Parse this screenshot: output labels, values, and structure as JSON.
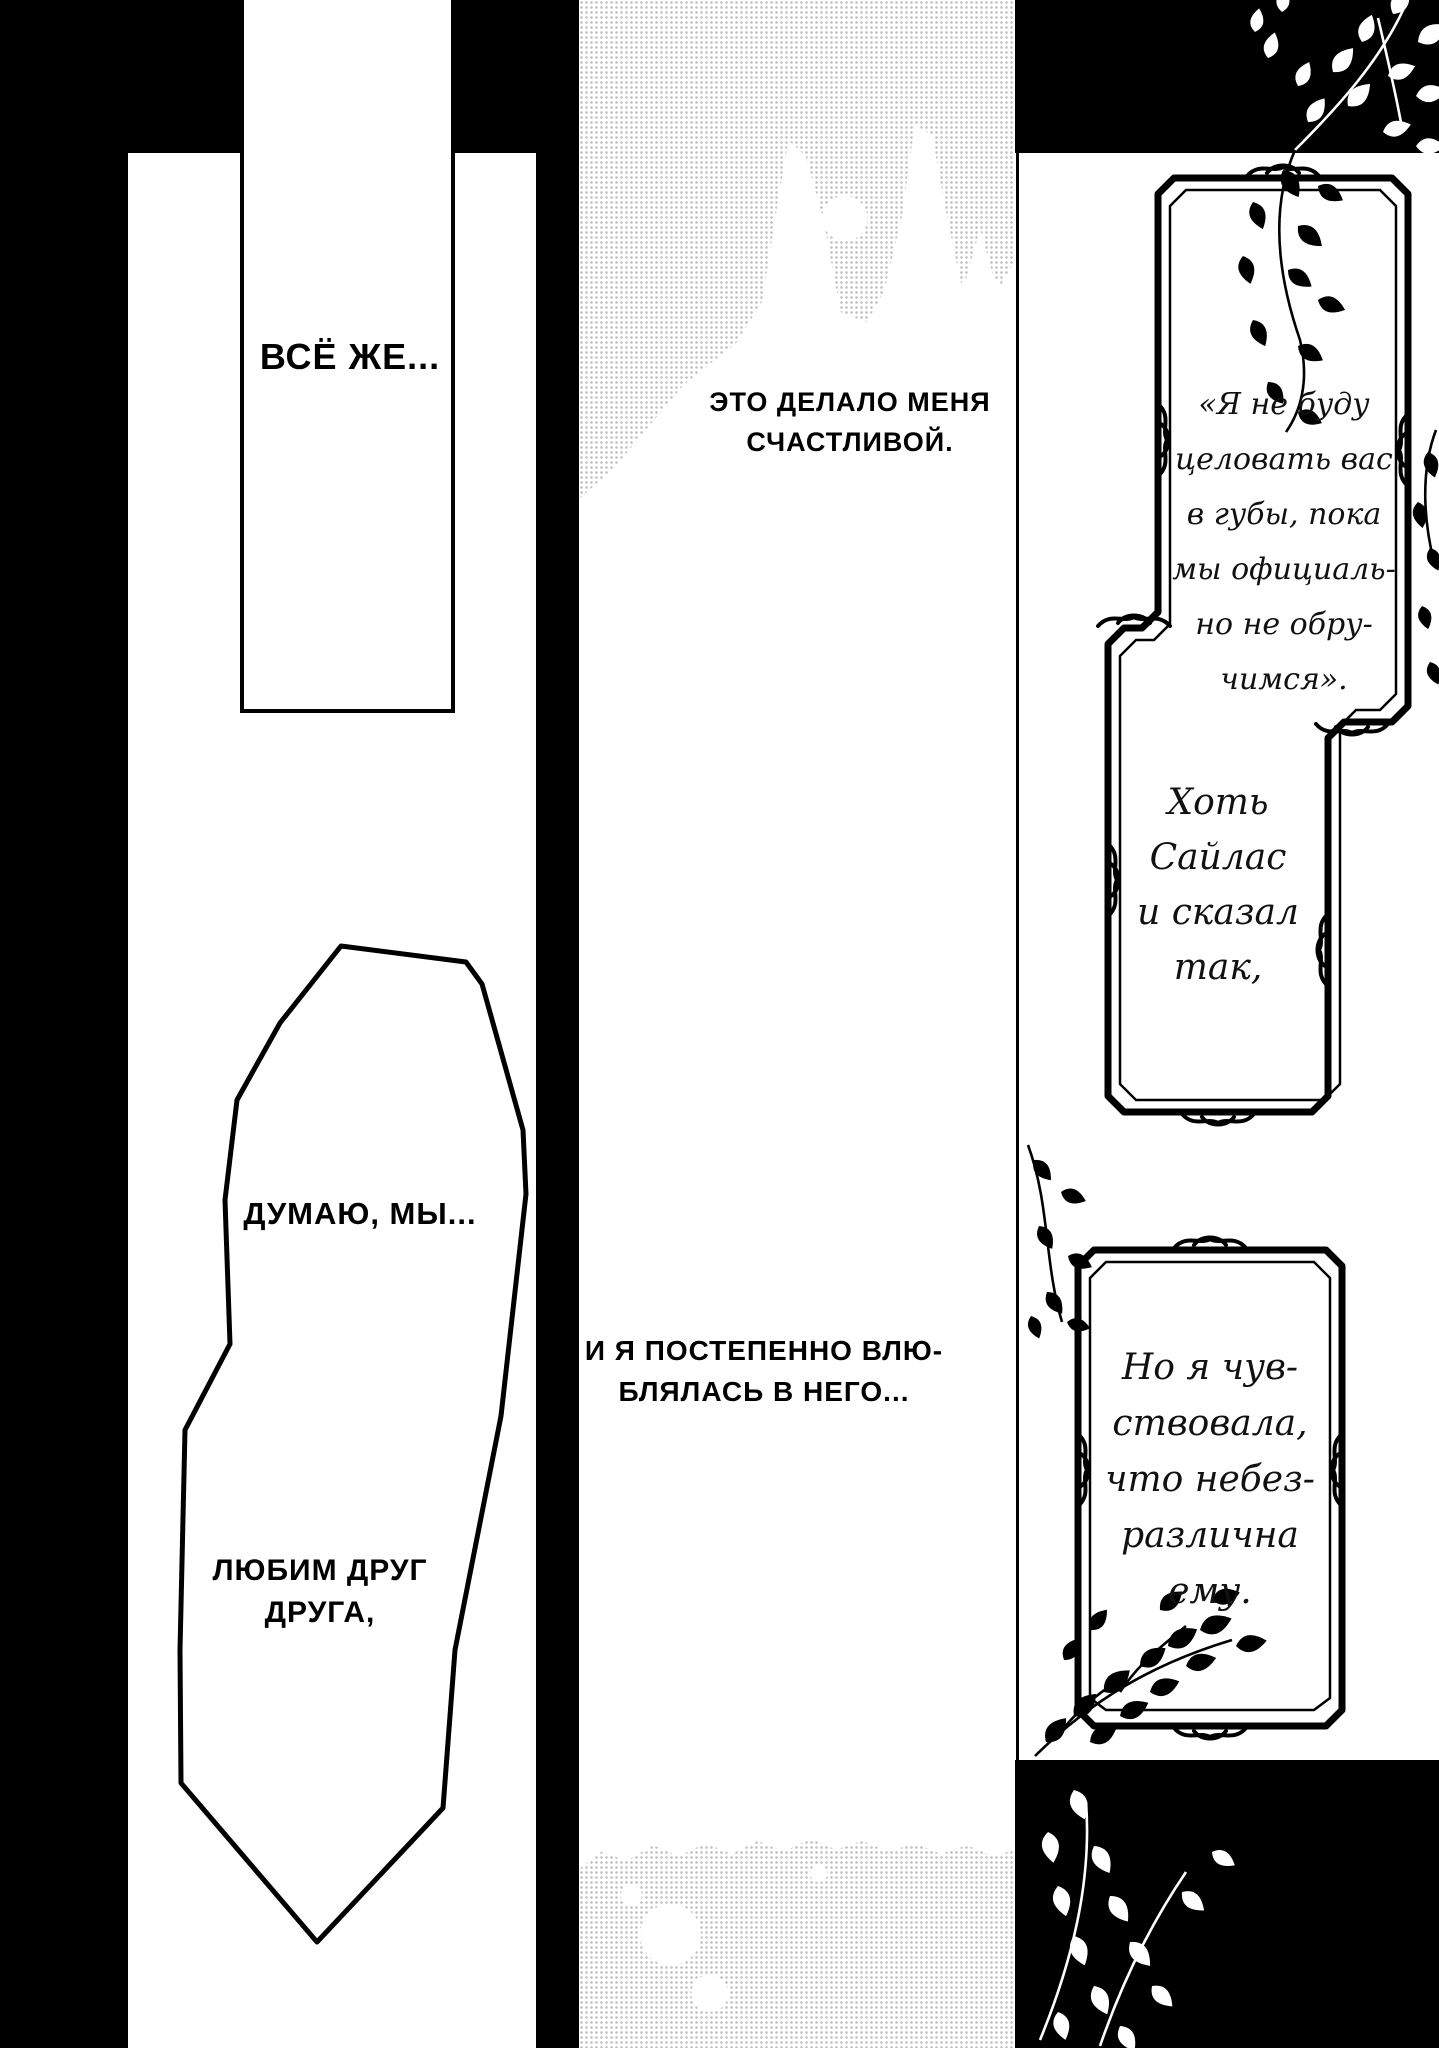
{
  "page_type": "manga-page",
  "colors": {
    "ink": "#000000",
    "paper": "#ffffff",
    "halftone_dot": "#bfbfbf"
  },
  "left_panel": {
    "top_caption": "ВСЁ ЖЕ...",
    "bubble": {
      "caption1": "ДУМАЮ, МЫ...",
      "caption2_line1": "ЛЮБИМ ДРУГ",
      "caption2_line2": "ДРУГА,"
    }
  },
  "middle_panel": {
    "top_caption": {
      "line1": "ЭТО ДЕЛАЛО МЕНЯ",
      "line2": "СЧАСТЛИВОЙ."
    },
    "bottom_caption": {
      "line1": "И Я ПОСТЕПЕННО ВЛЮ-",
      "line2": "БЛЯЛАСЬ В НЕГО..."
    }
  },
  "right_panel": {
    "quote_box": {
      "line1": "«Я не буду",
      "line2": "целовать вас",
      "line3": "в губы, пока",
      "line4": "мы официаль-",
      "line5": "но не обру-",
      "line6": "чимся»."
    },
    "narration_box_1": {
      "line1": "Хоть",
      "line2": "Сайлас",
      "line3": "и сказал",
      "line4": "так,"
    },
    "narration_box_2": {
      "line1": "Но я чув-",
      "line2": "ствовала,",
      "line3": "что небез-",
      "line4": "различна",
      "line5": "ему."
    }
  }
}
